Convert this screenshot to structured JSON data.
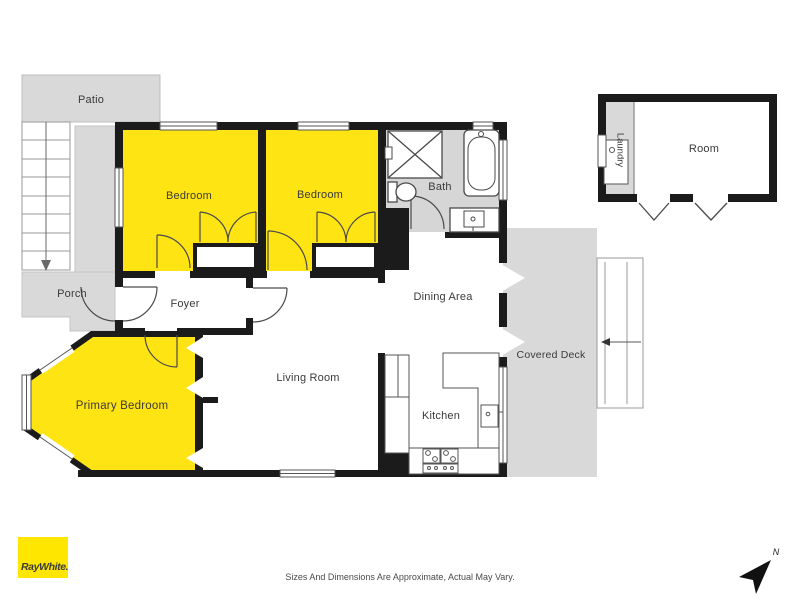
{
  "rooms": {
    "patio": {
      "label": "Patio"
    },
    "porch": {
      "label": "Porch"
    },
    "foyer": {
      "label": "Foyer"
    },
    "bedroom1": {
      "label": "Bedroom"
    },
    "bedroom2": {
      "label": "Bedroom"
    },
    "bath": {
      "label": "Bath"
    },
    "dining": {
      "label": "Dining Area"
    },
    "living": {
      "label": "Living Room"
    },
    "kitchen": {
      "label": "Kitchen"
    },
    "primary": {
      "label": "Primary Bedroom"
    },
    "deck": {
      "label": "Covered Deck"
    },
    "room": {
      "label": "Room"
    },
    "laundry": {
      "label": "Laundry"
    }
  },
  "footer": {
    "logo_text": "RayWhite.",
    "disclaimer": "Sizes And Dimensions Are Approximate, Actual May Vary."
  },
  "compass": {
    "label": "N"
  },
  "colors": {
    "highlight_yellow": "#ffe413",
    "area_gray": "#d9d9d9",
    "wall_black": "#1b1b1b",
    "brand_yellow": "#fee600",
    "fixture_line": "#4a4a4a"
  }
}
